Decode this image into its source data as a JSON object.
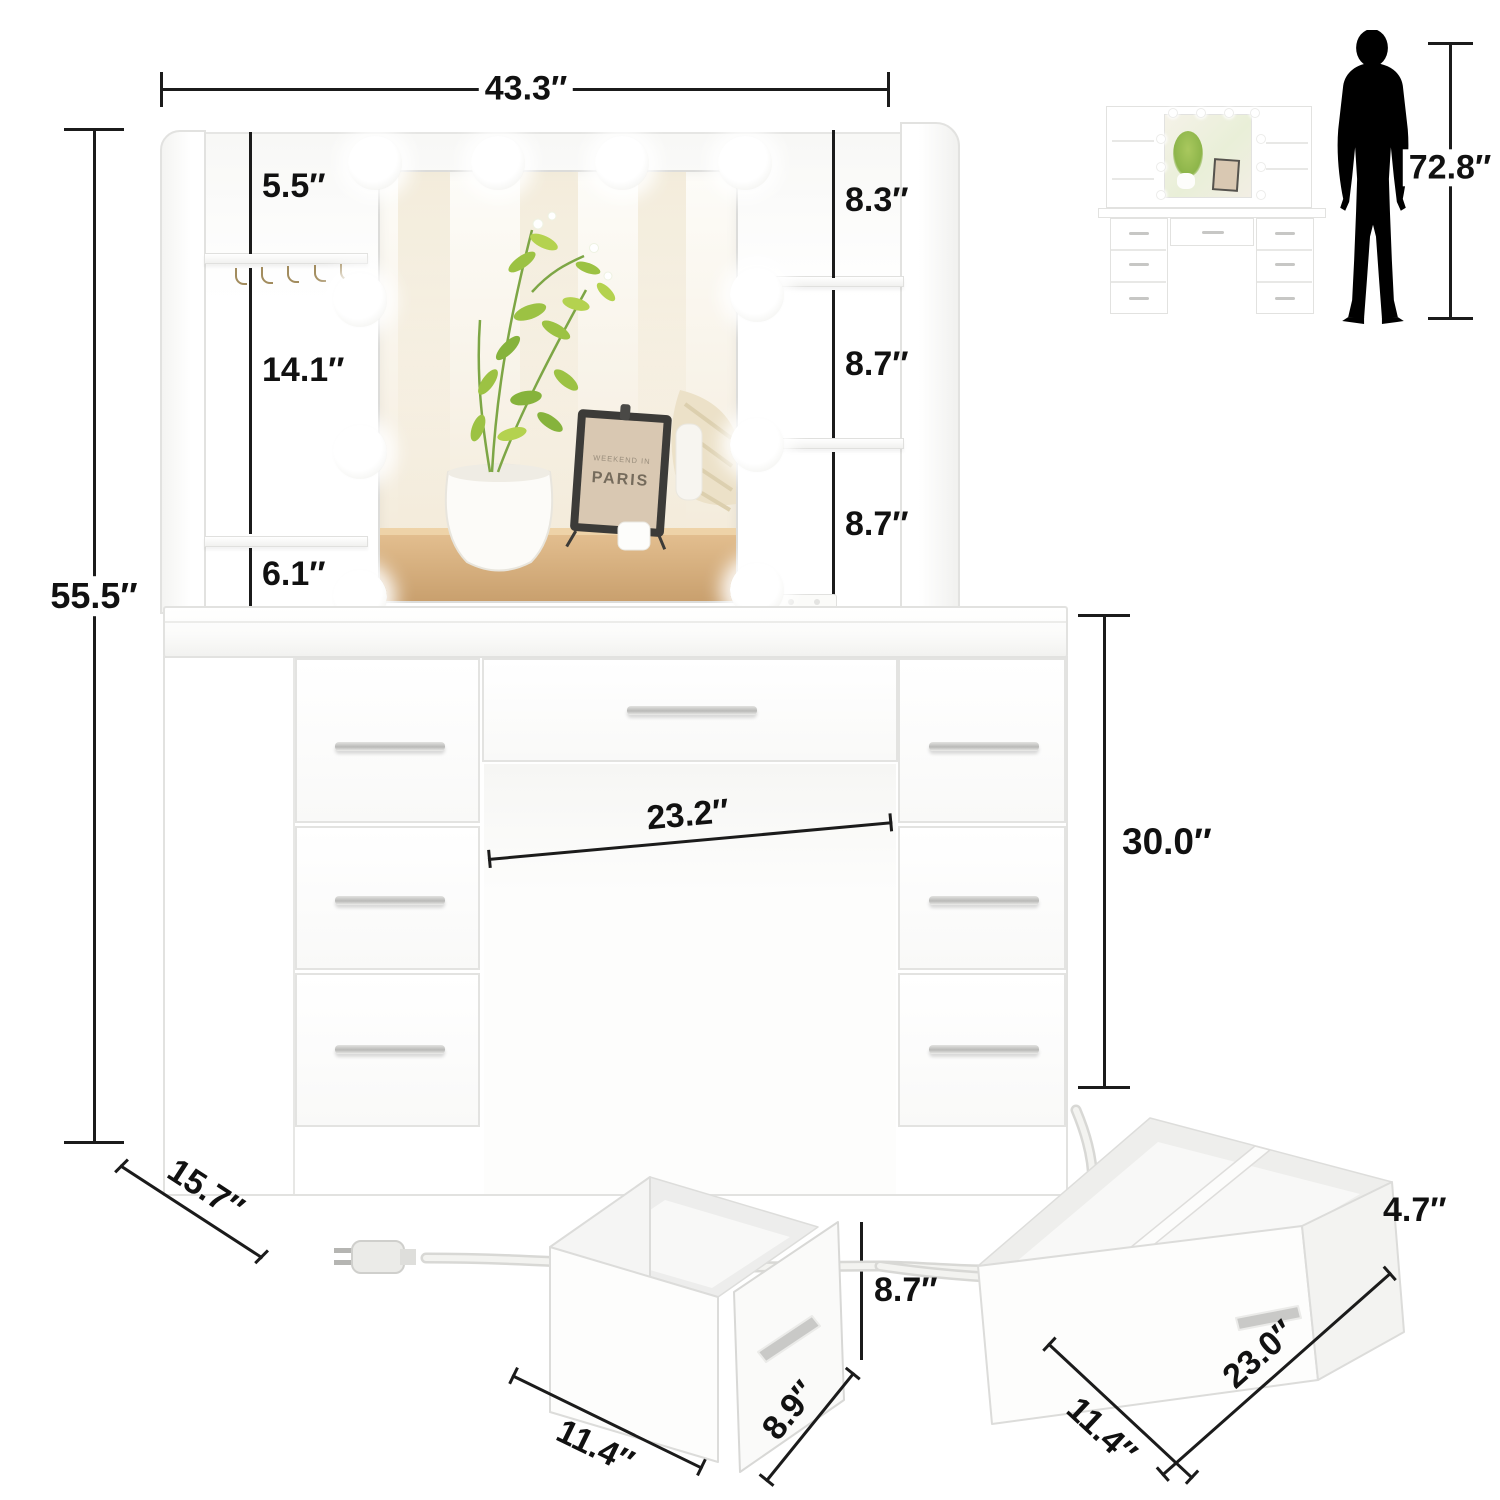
{
  "product": {
    "type": "makeup vanity desk with lighted mirror, shelves and 7 drawers",
    "view": "front dimension diagram with detail drawers, scale thumbnail and person silhouette"
  },
  "dimensions": {
    "top_width": "43.3″",
    "total_height": "55.5″",
    "person_height": "72.8″",
    "shelf_left_top": "5.5″",
    "shelf_left_middle": "14.1″",
    "shelf_left_bottom": "6.1″",
    "shelf_right_top": "8.3″",
    "shelf_right_middle": "8.7″",
    "shelf_right_bottom": "8.7″",
    "knee_space_width": "23.2″",
    "desk_height": "30.0″",
    "desk_depth": "15.7″",
    "small_drawer_height": "8.7″",
    "small_drawer_width": "11.4″",
    "small_drawer_depth": "8.9″",
    "large_drawer_height": "4.7″",
    "large_drawer_depth": "11.4″",
    "large_drawer_width": "23.0″"
  },
  "mirror_scene": {
    "frame_text_top": "WEEKEND IN",
    "frame_text_main": "PARIS"
  },
  "counts": {
    "light_bulbs": 10,
    "jewelry_hooks": 5,
    "drawers": 7
  },
  "colors": {
    "background": "#ffffff",
    "dimension_line": "#1b1b1b",
    "dimension_text": "#111111",
    "furniture_edge": "#e2e2e0",
    "furniture_white": "#ffffff",
    "handle_silver": "#c6c6c4",
    "silhouette_black": "#000000",
    "plant_green": "#8fba4a",
    "wood_tan": "#d9b383"
  }
}
